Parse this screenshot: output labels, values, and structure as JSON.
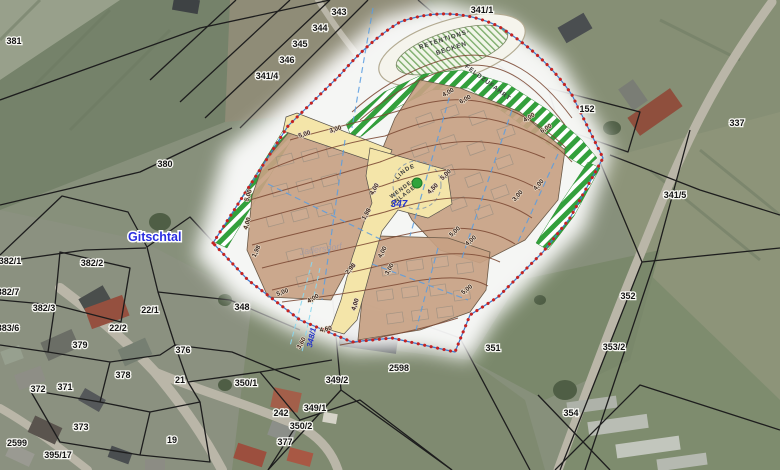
{
  "app": {
    "type": "gis-map-view",
    "place_label": "Gitschtal"
  },
  "colors": {
    "hatch_green": "#33a03c",
    "plan_tan": "#c7a183",
    "road_yellow": "#f4e5a9",
    "contour_brown": "#7d4a35",
    "boundary_blue": "#3f7ad0",
    "survey_red": "#c42323",
    "dashed_blue": "#5b9de0",
    "dashed_cyan": "#8ad8ef",
    "label_blue": "#2433cc",
    "place_blue": "#2a2ee0",
    "dot_green": "#2fa33c"
  },
  "plan": {
    "labels": {
      "dorflinde": "DORFLINDE",
      "wende_line1": "WENDE-",
      "wende_line2": "ANLAGE",
      "retention_line1": "RETENTIONS-",
      "retention_line2": "BECKEN",
      "feldzufahrt": "FELDZUFAHRT",
      "parcel_347": "347",
      "parcel_348_1": "348/1",
      "watermark": "Jadersdorf"
    },
    "measure_labels": [
      {
        "t": "5,00",
        "x": 305,
        "y": 136,
        "r": -18
      },
      {
        "t": "3,00",
        "x": 336,
        "y": 131,
        "r": -18
      },
      {
        "t": "5,00",
        "x": 250,
        "y": 196,
        "r": -72
      },
      {
        "t": "4,00",
        "x": 249,
        "y": 224,
        "r": -72
      },
      {
        "t": "1,98",
        "x": 258,
        "y": 252,
        "r": -65
      },
      {
        "t": "5,00",
        "x": 283,
        "y": 294,
        "r": -20
      },
      {
        "t": "4,00",
        "x": 314,
        "y": 300,
        "r": -30
      },
      {
        "t": "2,98",
        "x": 352,
        "y": 270,
        "r": -50
      },
      {
        "t": "1,98",
        "x": 368,
        "y": 215,
        "r": -60
      },
      {
        "t": "4,00",
        "x": 376,
        "y": 190,
        "r": -60
      },
      {
        "t": "4,00",
        "x": 449,
        "y": 94,
        "r": -28
      },
      {
        "t": "6,00",
        "x": 466,
        "y": 101,
        "r": -28
      },
      {
        "t": "4,00",
        "x": 530,
        "y": 119,
        "r": -32
      },
      {
        "t": "6,00",
        "x": 547,
        "y": 130,
        "r": -32
      },
      {
        "t": "5,00",
        "x": 447,
        "y": 176,
        "r": -45
      },
      {
        "t": "4,50",
        "x": 434,
        "y": 190,
        "r": -45
      },
      {
        "t": "3,00",
        "x": 519,
        "y": 197,
        "r": -48
      },
      {
        "t": "4,00",
        "x": 540,
        "y": 186,
        "r": -48
      },
      {
        "t": "5,00",
        "x": 456,
        "y": 233,
        "r": -42
      },
      {
        "t": "4,00",
        "x": 472,
        "y": 242,
        "r": -42
      },
      {
        "t": "4,00",
        "x": 384,
        "y": 253,
        "r": -62
      },
      {
        "t": "3,00",
        "x": 391,
        "y": 270,
        "r": -62
      },
      {
        "t": "5,00",
        "x": 468,
        "y": 291,
        "r": -38
      },
      {
        "t": "4,00",
        "x": 357,
        "y": 305,
        "r": -72
      },
      {
        "t": "4,60",
        "x": 326,
        "y": 331,
        "r": -10
      },
      {
        "t": "3,60",
        "x": 303,
        "y": 344,
        "r": -60
      }
    ]
  },
  "parcels": {
    "labels": [
      {
        "t": "381",
        "x": 14,
        "y": 44
      },
      {
        "t": "343",
        "x": 339,
        "y": 15
      },
      {
        "t": "344",
        "x": 320,
        "y": 31
      },
      {
        "t": "345",
        "x": 300,
        "y": 47
      },
      {
        "t": "346",
        "x": 287,
        "y": 63
      },
      {
        "t": "341/4",
        "x": 267,
        "y": 79
      },
      {
        "t": "341/1",
        "x": 482,
        "y": 13
      },
      {
        "t": "152",
        "x": 587,
        "y": 112
      },
      {
        "t": "337",
        "x": 737,
        "y": 126
      },
      {
        "t": "341/5",
        "x": 675,
        "y": 198
      },
      {
        "t": "380",
        "x": 165,
        "y": 167
      },
      {
        "t": "382/2",
        "x": 92,
        "y": 266
      },
      {
        "t": "382/1",
        "x": 10,
        "y": 264
      },
      {
        "t": "382/7",
        "x": 8,
        "y": 295
      },
      {
        "t": "382/3",
        "x": 44,
        "y": 311
      },
      {
        "t": "383/6",
        "x": 8,
        "y": 331
      },
      {
        "t": "22/2",
        "x": 118,
        "y": 331
      },
      {
        "t": "379",
        "x": 80,
        "y": 348
      },
      {
        "t": "378",
        "x": 123,
        "y": 378
      },
      {
        "t": "372",
        "x": 38,
        "y": 392
      },
      {
        "t": "371",
        "x": 65,
        "y": 390
      },
      {
        "t": "373",
        "x": 81,
        "y": 430
      },
      {
        "t": "2599",
        "x": 17,
        "y": 446
      },
      {
        "t": "395/17",
        "x": 58,
        "y": 458
      },
      {
        "t": "22/1",
        "x": 150,
        "y": 313
      },
      {
        "t": "348",
        "x": 242,
        "y": 310
      },
      {
        "t": "376",
        "x": 183,
        "y": 353
      },
      {
        "t": "21",
        "x": 180,
        "y": 383
      },
      {
        "t": "350/1",
        "x": 246,
        "y": 386
      },
      {
        "t": "349/2",
        "x": 337,
        "y": 383
      },
      {
        "t": "242",
        "x": 281,
        "y": 416
      },
      {
        "t": "349/1",
        "x": 315,
        "y": 411
      },
      {
        "t": "350/2",
        "x": 301,
        "y": 429
      },
      {
        "t": "377",
        "x": 285,
        "y": 445
      },
      {
        "t": "19",
        "x": 172,
        "y": 443
      },
      {
        "t": "2598",
        "x": 399,
        "y": 371
      },
      {
        "t": "351",
        "x": 493,
        "y": 351
      },
      {
        "t": "352",
        "x": 628,
        "y": 299
      },
      {
        "t": "353/2",
        "x": 614,
        "y": 350
      },
      {
        "t": "354",
        "x": 571,
        "y": 416
      }
    ]
  }
}
